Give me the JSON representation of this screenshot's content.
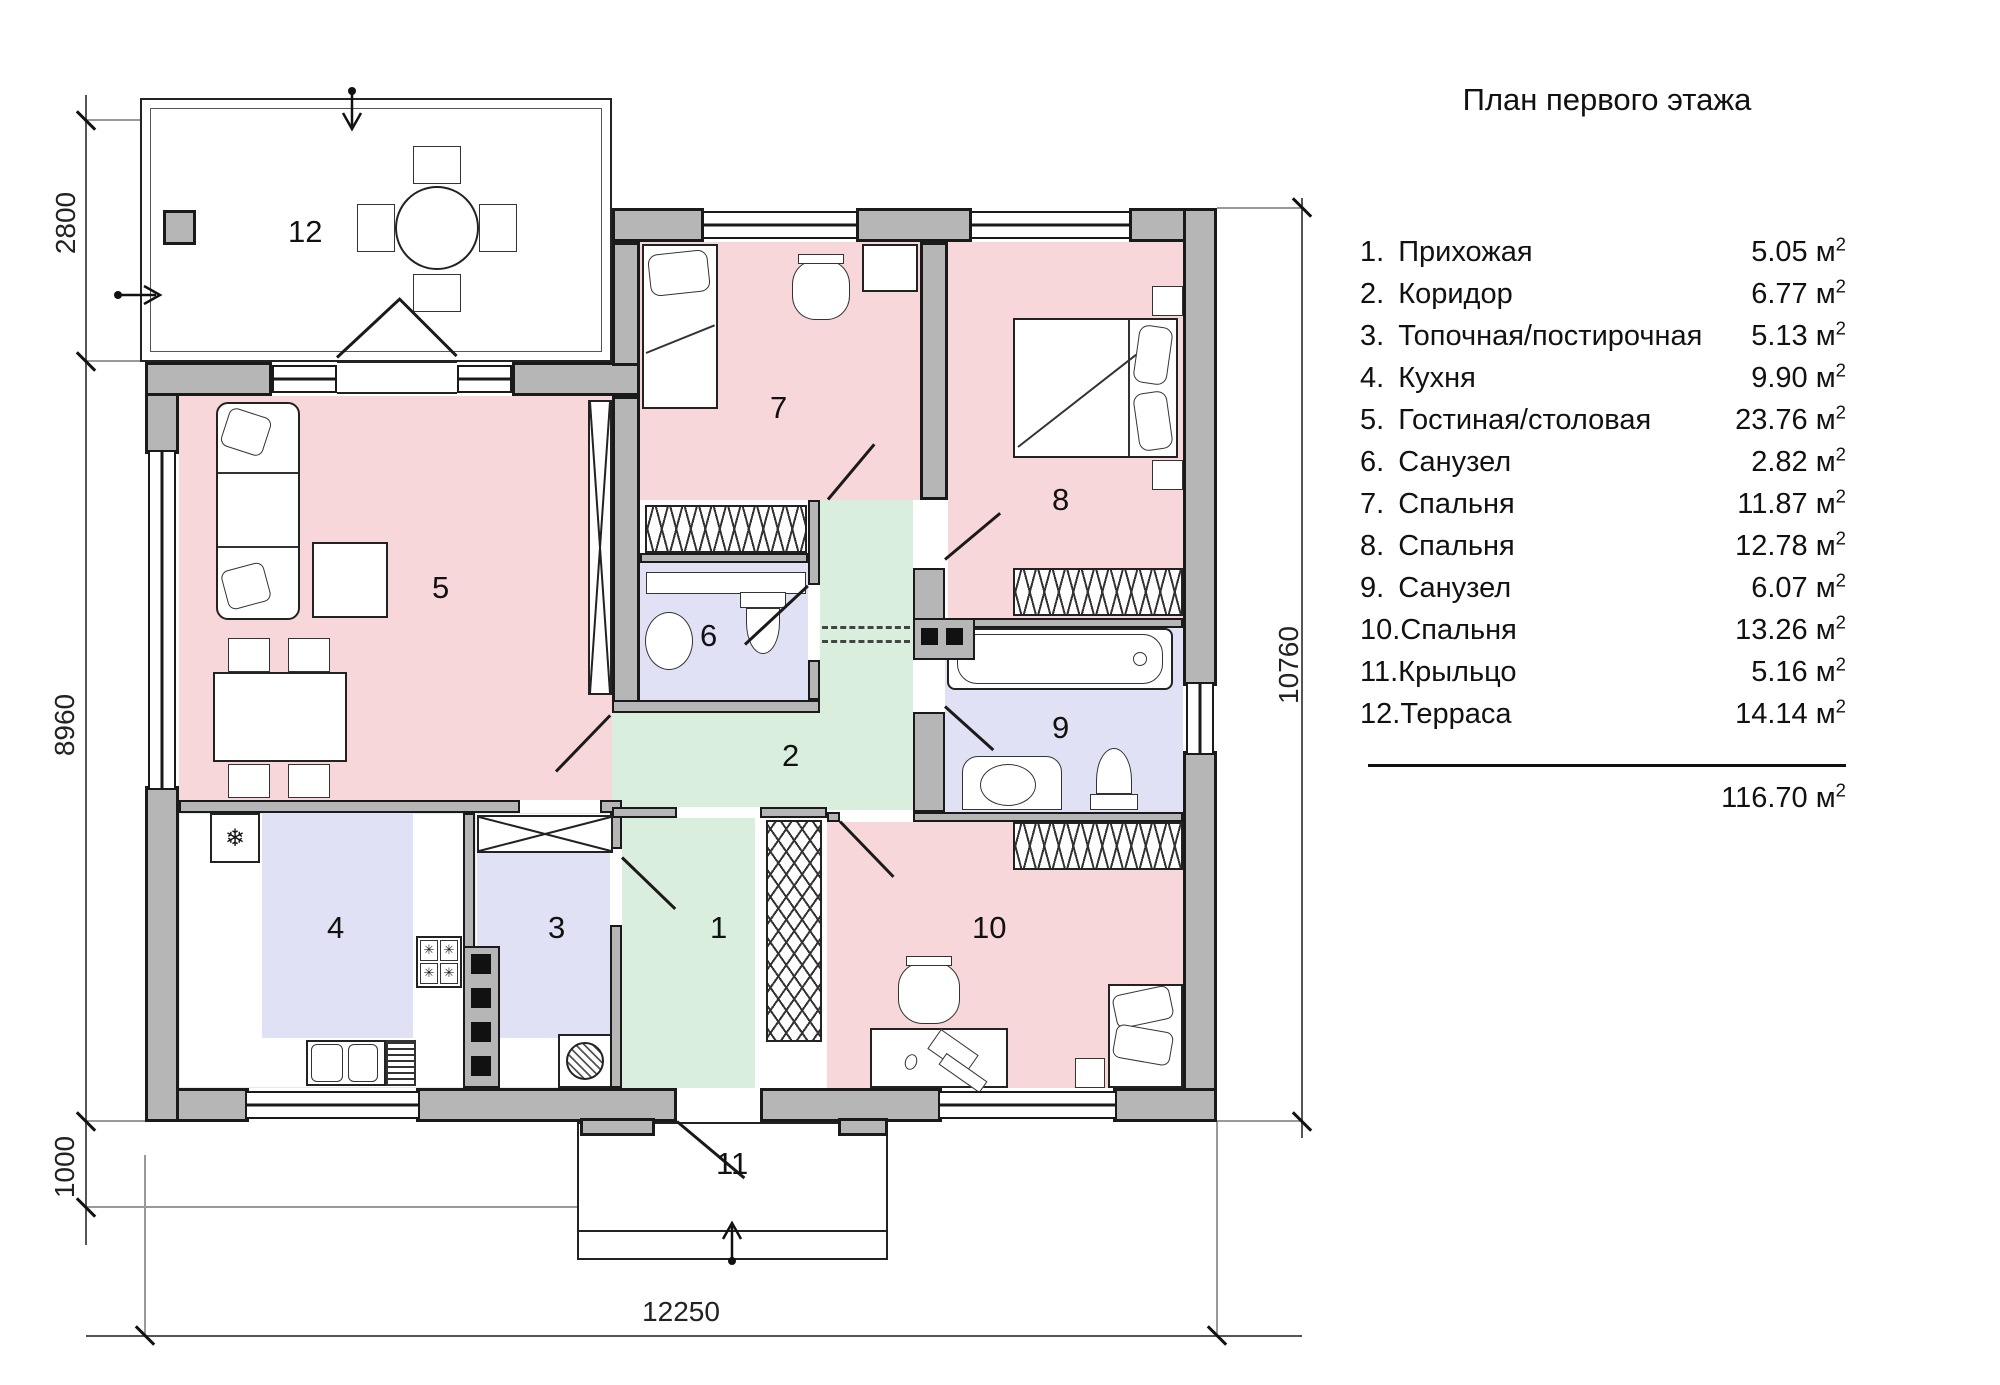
{
  "title": "План первого этажа",
  "legend": {
    "items": [
      {
        "num": "1.",
        "name": "Прихожая",
        "area": "5.05"
      },
      {
        "num": "2.",
        "name": "Коридор",
        "area": "6.77"
      },
      {
        "num": "3.",
        "name": "Топочная/постирочная",
        "area": "5.13"
      },
      {
        "num": "4.",
        "name": "Кухня",
        "area": "9.90"
      },
      {
        "num": "5.",
        "name": "Гостиная/столовая",
        "area": "23.76"
      },
      {
        "num": "6.",
        "name": "Санузел",
        "area": "2.82"
      },
      {
        "num": "7.",
        "name": "Спальня",
        "area": "11.87"
      },
      {
        "num": "8.",
        "name": "Спальня",
        "area": "12.78"
      },
      {
        "num": "9.",
        "name": "Санузел",
        "area": "6.07"
      },
      {
        "num": "10.",
        "name": "Спальня",
        "area": "13.26"
      },
      {
        "num": "11.",
        "name": "Крыльцо",
        "area": "5.16"
      },
      {
        "num": "12.",
        "name": "Терраса",
        "area": "14.14"
      }
    ],
    "unit": "м",
    "sup": "2",
    "total": "116.70"
  },
  "plan": {
    "rooms": [
      "1",
      "2",
      "3",
      "4",
      "5",
      "6",
      "7",
      "8",
      "9",
      "10",
      "11",
      "12"
    ],
    "icons": {
      "fridge": "❄",
      "burner": "✳"
    }
  },
  "dimensions": {
    "left": [
      "2800",
      "8960",
      "1000"
    ],
    "right": [
      "10760"
    ],
    "bottom": [
      "12250"
    ]
  },
  "palette": {
    "room_pink": "#f8d7db",
    "room_green": "#d9eedd",
    "room_lavender": "#e1e1f6",
    "wall_gray": "#b6b6b6",
    "line_black": "#1a1a1a"
  }
}
